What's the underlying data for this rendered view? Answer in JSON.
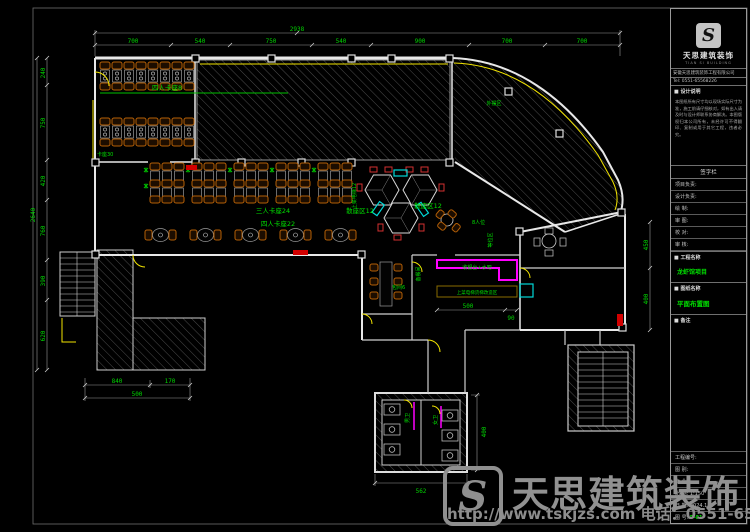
{
  "sheet": {
    "titleblock": {
      "logo_letter": "S",
      "brand": "天思建筑装饰",
      "brand_sub": "TIAN SI BUILDING",
      "company": "安徽天思建筑装饰工程有限公司",
      "tel": "Tel: 0551-65568226",
      "section_notes": "■ 设计说明",
      "notes": "本图纸所有尺寸均以现场实际尺寸为准，施工前请仔细核对，如有出入请及时与设计师联系协商解决。本图版权归本公司所有，未经许可不得翻印、复制或用于其它工程，违者必究。",
      "sign_header": "签字栏",
      "sign_rows": [
        "项目负责:",
        "设计负责:",
        "绘  制:",
        "审  图:",
        "校  对:",
        "审  核:"
      ],
      "section_project": "■ 工程名称",
      "project_name": "龙虾馆项目",
      "section_drawing": "■ 图纸名称",
      "drawing_name": "平面布置图",
      "section_remark": "■ 备注",
      "info_rows": [
        "工程编号:",
        "图  别:",
        "专  业:"
      ],
      "scale_row": "比  例: 1:150",
      "date_row": "日  期: 2024.11",
      "no_label": "图  号:",
      "no_value": "P-01"
    },
    "watermark": {
      "logo_letter": "S",
      "brand": "天思建筑装饰",
      "url": "http://www.tskjzs.com 电话：0551-65568226"
    }
  },
  "plan": {
    "labels": {
      "zone1": "四人卡座8",
      "zone2": "卡座30",
      "zone3": "三人卡座24",
      "zone4": "四人卡座22",
      "hex1": "散座区12",
      "hex2": "散座区12",
      "lift": "上菜电梯12",
      "seat8": "8人位",
      "waiting": "等位区",
      "outdoor": "外摆区",
      "room6": "包间6",
      "pantry": "备餐间",
      "cashier": "收银台+水吧",
      "lift2": "上菜电梯货梯改造区",
      "wc_m": "男卫",
      "wc_f": "女卫"
    },
    "dims": {
      "top_total": "2938",
      "top": [
        "700",
        "540",
        "750",
        "540",
        "900",
        "700",
        "700"
      ],
      "left_total": "2640",
      "left": [
        "240",
        "750",
        "420",
        "760",
        "390",
        "620"
      ],
      "bottom_left": [
        "840",
        "170"
      ],
      "bottom_left_total": "500",
      "toilet_bottom": "562",
      "toilet_right": "400",
      "right": [
        "450",
        "400"
      ],
      "cashier": [
        "500",
        "90"
      ]
    },
    "colors": {
      "dim_green": "#00d400",
      "wall_white": "#e8e8e8",
      "accent_yellow": "#f2e400",
      "accent_magenta": "#ff00ff",
      "accent_cyan": "#00d8d8",
      "accent_red": "#d23030",
      "chair_orange": "#b45f06"
    }
  }
}
